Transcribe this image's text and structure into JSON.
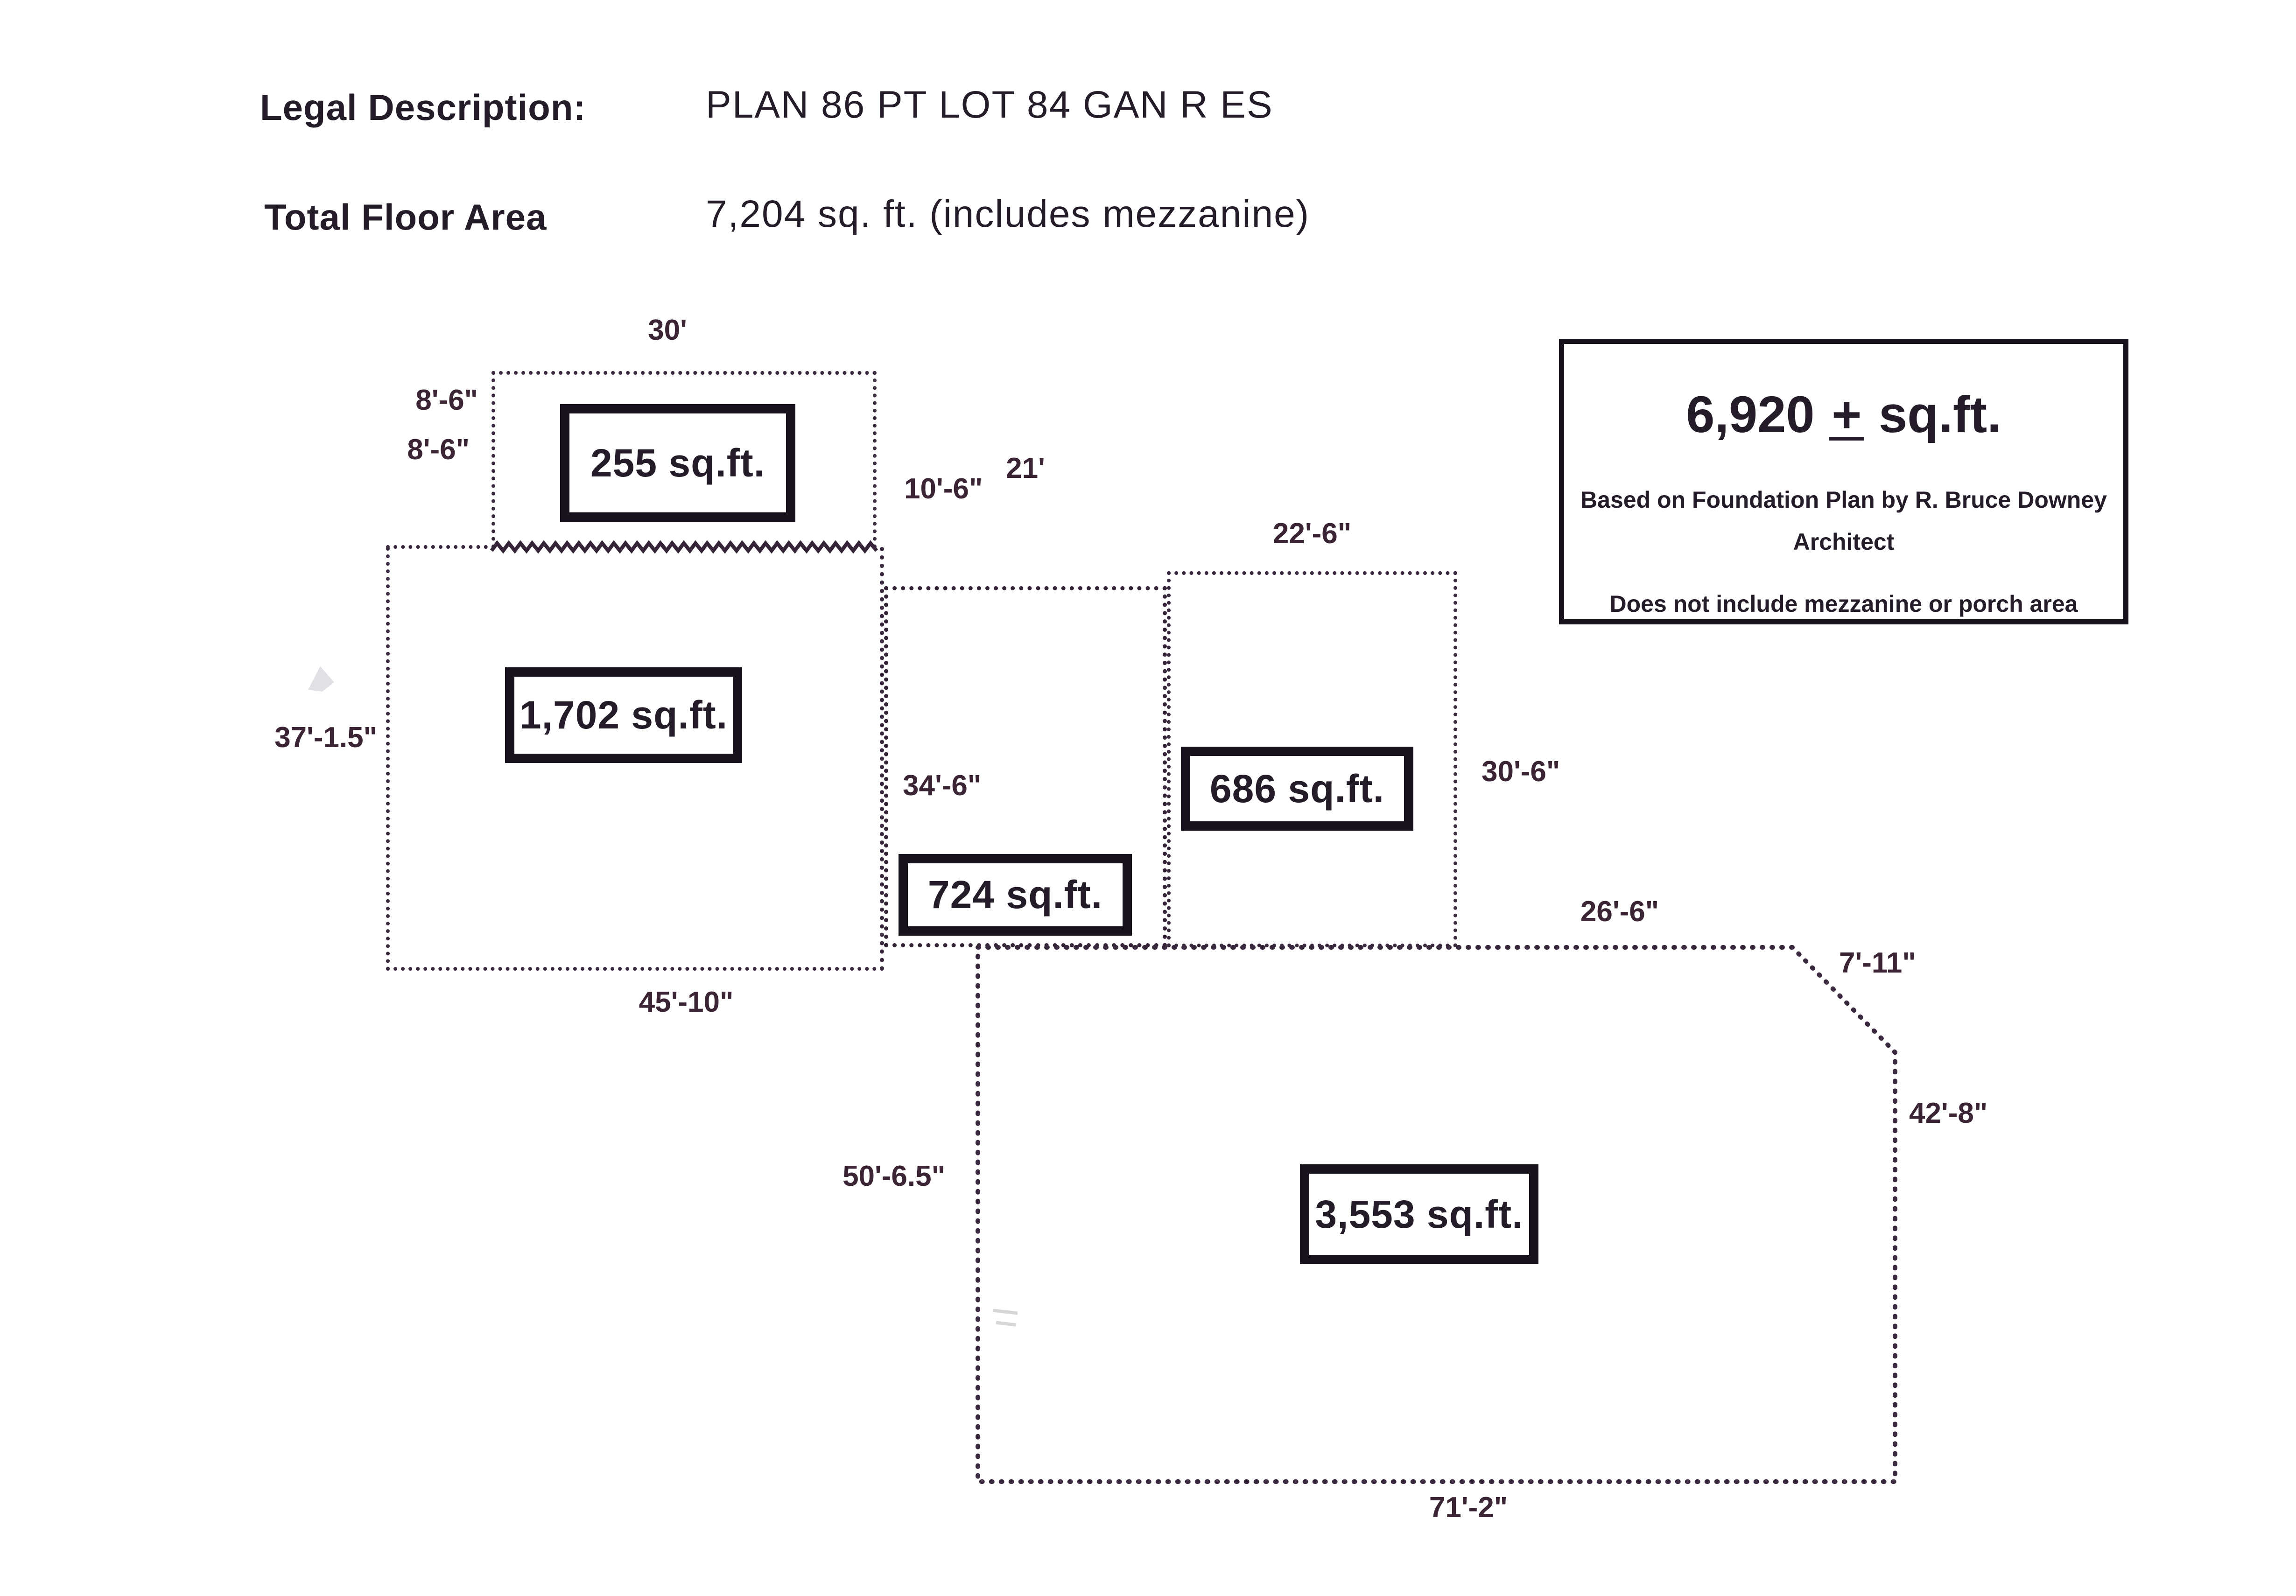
{
  "header": {
    "legal_label": "Legal Description:",
    "legal_value": "PLAN 86 PT LOT 84 GAN R ES",
    "floor_label": "Total Floor Area",
    "floor_value": "7,204 sq. ft. (includes mezzanine)"
  },
  "note_box": {
    "area_value": "6,920",
    "plus_sign": "+",
    "area_unit": "sq.ft.",
    "line1": "Based on Foundation Plan by R. Bruce Downey",
    "line2": "Architect",
    "line3": "Does not include mezzanine or porch area"
  },
  "sections": {
    "porch": {
      "area": "255 sq.ft.",
      "dim_top": "30'",
      "dim_left_upper": "8'-6\"",
      "dim_left_lower": "8'-6\"",
      "dim_right": "10'-6\""
    },
    "main": {
      "area": "1,702 sq.ft.",
      "dim_left": "37'-1.5\"",
      "dim_bottom": "45'-10\""
    },
    "mid": {
      "area": "724 sq.ft.",
      "dim_top": "21'",
      "dim_left": "34'-6\""
    },
    "right": {
      "area": "686 sq.ft.",
      "dim_top": "22'-6\"",
      "dim_right": "30'-6\""
    },
    "bottom": {
      "area": "3,553 sq.ft.",
      "dim_top_right": "26'-6\"",
      "dim_diagonal": "7'-11\"",
      "dim_right": "42'-8\"",
      "dim_left": "50'-6.5\"",
      "dim_bottom": "71'-2\""
    }
  },
  "colors": {
    "ink": "#241c28",
    "dotted_line": "#3b2940",
    "box_border": "#18121c",
    "background": "#ffffff"
  }
}
